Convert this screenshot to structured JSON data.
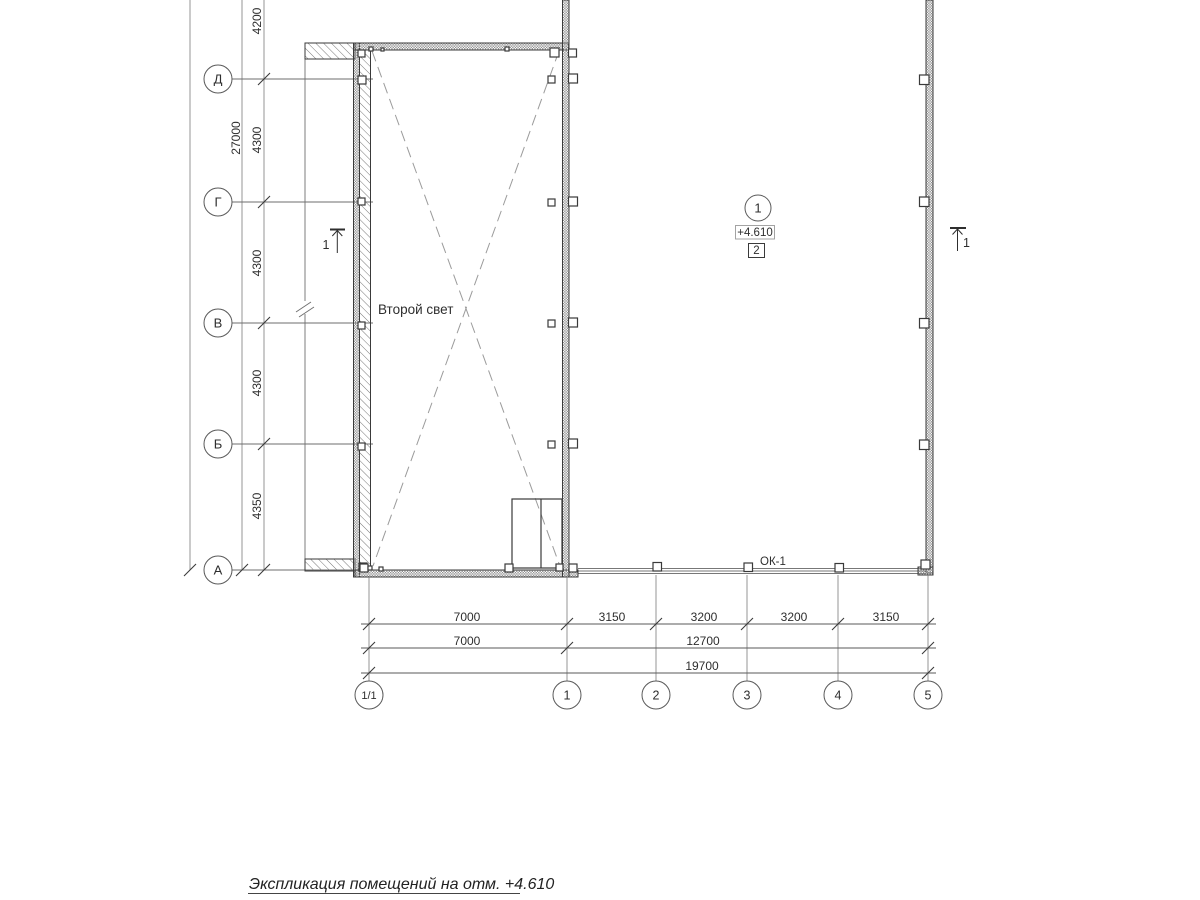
{
  "plan": {
    "title": "Экспликация помещений на отм. +4.610",
    "row_axes": [
      {
        "label": "Д"
      },
      {
        "label": "Г"
      },
      {
        "label": "В"
      },
      {
        "label": "Б"
      },
      {
        "label": "А"
      }
    ],
    "col_axes": [
      {
        "label": "1/1"
      },
      {
        "label": "1"
      },
      {
        "label": "2"
      },
      {
        "label": "3"
      },
      {
        "label": "4"
      },
      {
        "label": "5"
      }
    ],
    "left_dims": {
      "top_span": "4200",
      "total": "27000",
      "spans": [
        "4300",
        "4300",
        "4300",
        "4350"
      ]
    },
    "bottom_dims": {
      "row1": [
        "7000",
        "3150",
        "3200",
        "3200",
        "3150"
      ],
      "row2": [
        "7000",
        "12700"
      ],
      "row3": [
        "19700"
      ]
    },
    "room": {
      "number": "1",
      "elevation": "+4.610",
      "zone": "2"
    },
    "annotations": {
      "second_light": "Второй свет",
      "window_mark": "ОК-1",
      "section_mark": "1"
    },
    "colors": {
      "line": "#3a3a3a",
      "grid": "#6e6e6e",
      "dashed": "#9b9b9b",
      "hatch": "#787878",
      "text": "#2e2e2e",
      "background": "#ffffff"
    }
  }
}
